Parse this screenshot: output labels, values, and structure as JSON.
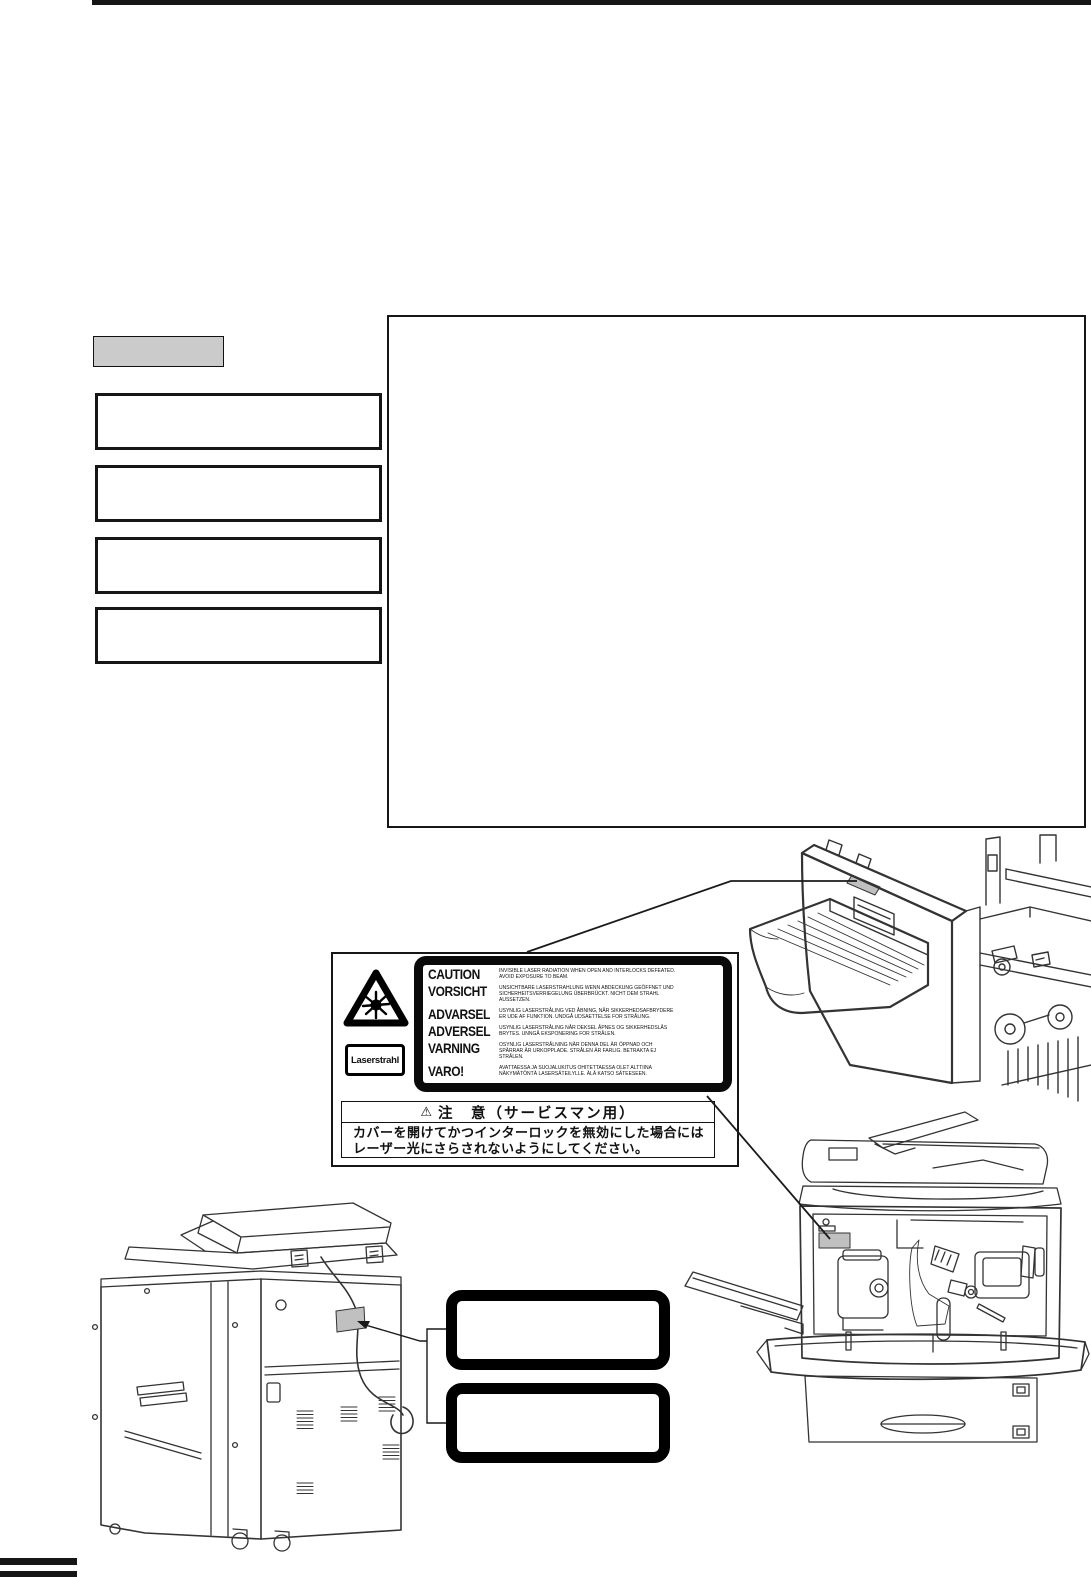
{
  "document": {
    "colors": {
      "ink": "#111111",
      "label_shading": "#c0c0c0",
      "placeholder_fill": "#cbcbcb"
    },
    "laser_label": {
      "rows": [
        {
          "word": "CAUTION",
          "text": "INVISIBLE LASER RADIATION WHEN OPEN AND INTERLOCKS DEFEATED. AVOID EXPOSURE TO BEAM."
        },
        {
          "word": "VORSICHT",
          "text": "UNSICHTBARE LASERSTRAHLUNG WENN ABDECKUNG GEÖFFNET UND SICHERHEITSVERRIEGELUNG ÜBERBRÜCKT. NICHT DEM STRAHL AUSSETZEN."
        },
        {
          "word": "ADVARSEL",
          "text": "USYNLIG LASERSTRÅLING VED ÅBNING, NÅR SIKKERHEDSAFBRYDERE ER UDE AF FUNKTION. UNDGÅ UDSAETTELSE FOR STRÅLING."
        },
        {
          "word": "ADVERSEL",
          "text": "USYNLIG LASERSTRÅLING NÅR DEKSEL ÅPNES OG SIKKERHEDSLÅS BRYTES. UNNGÅ EKSPONERING FOR STRÅLEN."
        },
        {
          "word": "VARNING",
          "text": "OSYNLIG LASERSTRÅLNING NÄR DENNA DEL ÄR ÖPPNAD OCH SPÄRRAR ÄR URKOPPLADE. STRÅLEN ÄR FARLIG. BETRAKTA EJ STRÅLEN."
        },
        {
          "word": "VARO!",
          "text": "AVATTAESSA JA SUOJALUKITUS OHITETTAESSA OLET ALTTIINA NÄKYMÄTÖNTÄ LASERSÄTEILYLLE. ÄLÄ KATSO SÄTEESEEN."
        }
      ],
      "laserstrahl_label": "Laserstrahl"
    },
    "service_notice": {
      "warning_glyph": "⚠",
      "title": "注　意（サービスマン用）",
      "lines": [
        "カバーを開けてかつインターロックを無効にした場合には",
        "レーザー光にさらされないようにしてください。"
      ]
    },
    "icons": [
      "laser-burst-icon",
      "warning-triangle-icon"
    ]
  }
}
